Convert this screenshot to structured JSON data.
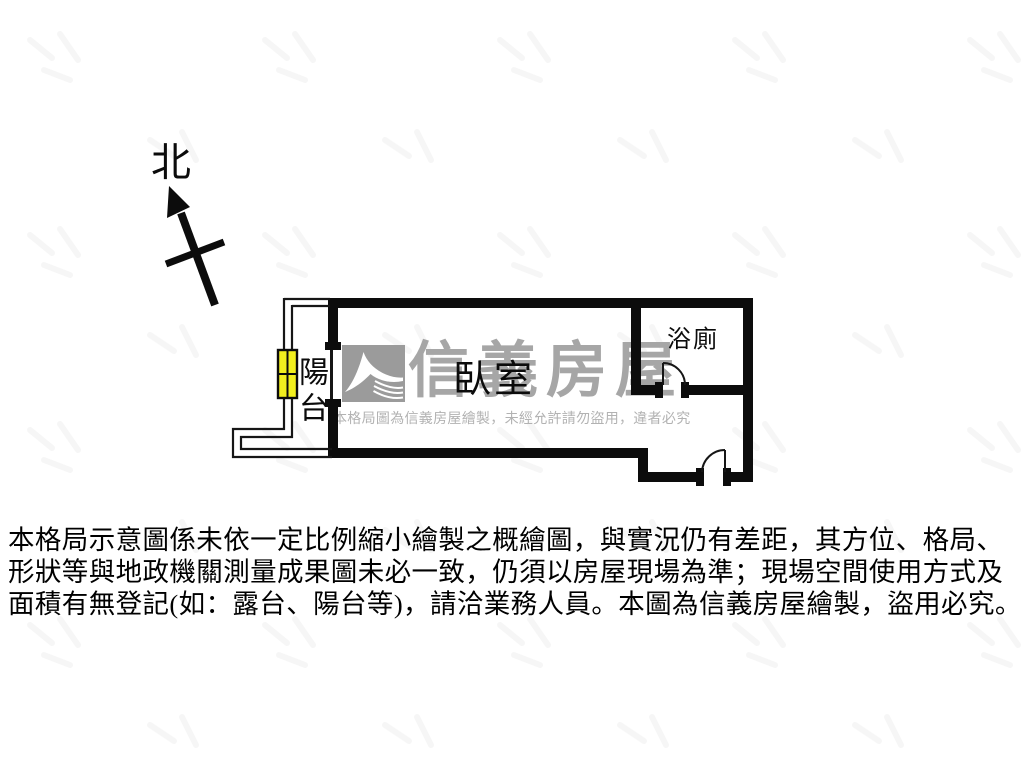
{
  "compass": {
    "north_label": "北"
  },
  "floor_plan": {
    "rooms": [
      {
        "id": "balcony",
        "label": "陽台"
      },
      {
        "id": "bedroom",
        "label": "臥室"
      },
      {
        "id": "bathroom",
        "label": "浴廁"
      }
    ]
  },
  "watermark": {
    "brand_name": "信義房屋",
    "usage_notice": "本格局圖為信義房屋繪製，未經允許請勿盜用，違者必究"
  },
  "disclaimer": {
    "lines": [
      "本格局示意圖係未依一定比例縮小繪製之概繪圖，與實況仍有差距，其方位、格局、",
      "形狀等與地政機關測量成果圖未必一致，仍須以房屋現場為準；現場空間使用方式及",
      "面積有無登記(如：露台、陽台等)，請洽業務人員。本圖為信義房屋繪製，盜用必究。"
    ]
  },
  "colors": {
    "wall": "#0c0c0c",
    "line": "#161616",
    "window_fill": "#f2ef1e",
    "watermark_gray": "#a6a6a6",
    "watermark_small_gray": "#b2b2b2",
    "logo_gray": "#9b9b9b"
  }
}
